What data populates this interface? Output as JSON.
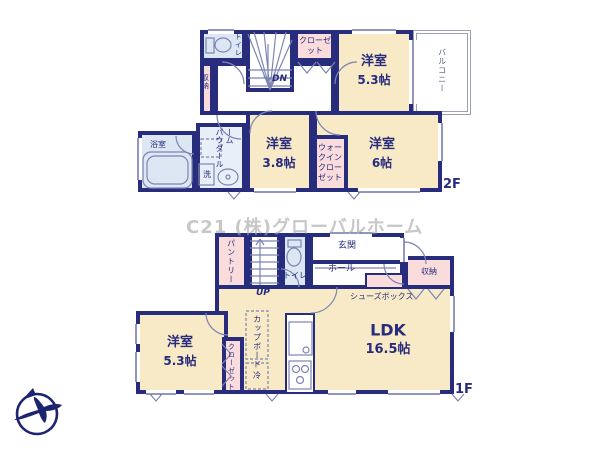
{
  "watermark": "C21 (株)グローバルホーム",
  "colors": {
    "wall_navy": "#272c7c",
    "room_cream": "#f8eac6",
    "closet_pink": "#fadcdc",
    "wet_area_blue": "#dde6f3",
    "fixture_line": "#7c85b3"
  },
  "f2": {
    "floor_label": "2F",
    "toilet": "トイレ",
    "closet": "クローゼット",
    "storage": "収納",
    "stairs_dn": "DN",
    "room53_name": "洋室",
    "room53_size": "5.3帖",
    "balcony": "バルコニー",
    "bath": "浴室",
    "powder_room": "パウダールーム",
    "washer": "洗",
    "room38_name": "洋室",
    "room38_size": "3.8帖",
    "wic": "ウォークインクローゼット",
    "room6_name": "洋室",
    "room6_size": "6帖"
  },
  "f1": {
    "floor_label": "1F",
    "pantry": "パントリー",
    "stairs_up": "UP",
    "toilet": "トイレ",
    "entrance": "玄関",
    "hall": "ホール",
    "shoe_box": "シューズボックス",
    "storage": "収納",
    "ldk_name": "LDK",
    "ldk_size": "16.5帖",
    "room53_name": "洋室",
    "room53_size": "5.3帖",
    "closet": "クローゼット",
    "cupboard": "カップボード",
    "fridge": "冷"
  }
}
